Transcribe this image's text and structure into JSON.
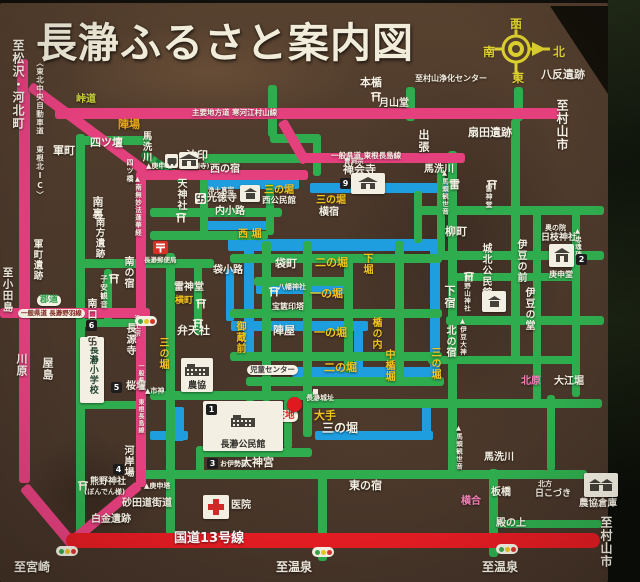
{
  "title": "長瀞ふるさと案内図",
  "compass": {
    "west": "西",
    "south": "南",
    "north": "北",
    "east": "東"
  },
  "colors": {
    "board_brown": "#4b382b",
    "road_pink": "#e5407e",
    "road_green": "#2fac4e",
    "road_red": "#e31c23",
    "moat_blue": "#1e9ede",
    "text_white": "#f4efe2",
    "text_yellow": "#f3c41d",
    "text_pink": "#f57fb8",
    "text_olive": "#c8d23e",
    "text_orange": "#e8a81c",
    "compass_yellow": "#ddd12f"
  },
  "labels": [
    {
      "t": "至松沢・河北町",
      "x": 12,
      "y": 36,
      "v": 1,
      "c": "w",
      "s": 12
    },
    {
      "t": "〈東北中央自動車道 東根北IC〉",
      "x": 36,
      "y": 56,
      "v": 1,
      "c": "w",
      "s": 7.5
    },
    {
      "t": "八反遺跡",
      "x": 541,
      "y": 66,
      "c": "w",
      "s": 11
    },
    {
      "t": "至村山浄化センター",
      "x": 415,
      "y": 72,
      "c": "w",
      "s": 8
    },
    {
      "t": "本楯",
      "x": 360,
      "y": 74,
      "c": "w",
      "s": 11
    },
    {
      "t": "月山堂",
      "x": 379,
      "y": 96,
      "c": "w",
      "s": 10
    },
    {
      "t": "至村山市",
      "x": 556,
      "y": 96,
      "v": 1,
      "c": "w",
      "s": 12
    },
    {
      "t": "扇田遺跡",
      "x": 468,
      "y": 124,
      "c": "w",
      "s": 11
    },
    {
      "t": "主要地方道 寒河江村山線",
      "x": 192,
      "y": 106,
      "c": "w",
      "s": 7.5
    },
    {
      "t": "一般県道 東根長島線",
      "x": 331,
      "y": 149,
      "c": "w",
      "s": 7.5
    },
    {
      "t": "峠道",
      "x": 76,
      "y": 92,
      "c": "yg",
      "s": 10
    },
    {
      "t": "陣場",
      "x": 118,
      "y": 116,
      "c": "o",
      "s": 11
    },
    {
      "t": "軍町",
      "x": 53,
      "y": 142,
      "c": "w",
      "s": 11
    },
    {
      "t": "四ツ壇",
      "x": 90,
      "y": 134,
      "c": "w",
      "s": 11
    },
    {
      "t": "馬洗川",
      "x": 141,
      "y": 128,
      "v": 1,
      "c": "w",
      "s": 9.5
    },
    {
      "t": "四ツ橋",
      "x": 126,
      "y": 156,
      "v": 1,
      "c": "w",
      "s": 7
    },
    {
      "t": "▲南無妙法蓮華経",
      "x": 134,
      "y": 172,
      "v": 1,
      "c": "w",
      "s": 6.5
    },
    {
      "t": "▲庚申塔",
      "x": 146,
      "y": 160,
      "c": "w",
      "s": 7
    },
    {
      "t": "法印",
      "x": 186,
      "y": 147,
      "c": "w",
      "s": 11
    },
    {
      "t": "(長源寺)",
      "x": 184,
      "y": 160,
      "c": "w",
      "s": 6.5
    },
    {
      "t": "西の宿",
      "x": 210,
      "y": 162,
      "c": "w",
      "s": 10
    },
    {
      "t": "天神社",
      "x": 175,
      "y": 175,
      "v": 1,
      "c": "w",
      "s": 10
    },
    {
      "t": "浄土真宗",
      "x": 208,
      "y": 184,
      "c": "w",
      "s": 6.5
    },
    {
      "t": "光徳寺",
      "x": 207,
      "y": 191,
      "c": "w",
      "s": 10
    },
    {
      "t": "三の堀",
      "x": 264,
      "y": 183,
      "c": "y",
      "s": 10
    },
    {
      "t": "西公民館",
      "x": 262,
      "y": 194,
      "c": "w",
      "s": 8.5
    },
    {
      "t": "内小路",
      "x": 215,
      "y": 204,
      "c": "w",
      "s": 10
    },
    {
      "t": "曹洞宗",
      "x": 344,
      "y": 155,
      "c": "w",
      "s": 6.5
    },
    {
      "t": "禅会寺",
      "x": 343,
      "y": 161,
      "c": "w",
      "s": 11
    },
    {
      "t": "馬洗川",
      "x": 424,
      "y": 162,
      "c": "w",
      "s": 10
    },
    {
      "t": "出張",
      "x": 418,
      "y": 126,
      "v": 1,
      "c": "w",
      "s": 11
    },
    {
      "t": "▲馬頭観世音",
      "x": 441,
      "y": 166,
      "v": 1,
      "c": "w",
      "s": 6.5
    },
    {
      "t": "西 堀",
      "x": 238,
      "y": 227,
      "c": "y",
      "s": 10
    },
    {
      "t": "袋小路",
      "x": 213,
      "y": 263,
      "c": "w",
      "s": 10
    },
    {
      "t": "袋町",
      "x": 275,
      "y": 255,
      "c": "w",
      "s": 11
    },
    {
      "t": "二の堀",
      "x": 315,
      "y": 254,
      "c": "y",
      "s": 11
    },
    {
      "t": "下堀",
      "x": 361,
      "y": 250,
      "v": 1,
      "c": "y",
      "s": 10
    },
    {
      "t": "八幡神社",
      "x": 278,
      "y": 281,
      "c": "w",
      "s": 7
    },
    {
      "t": "一の堀",
      "x": 310,
      "y": 285,
      "c": "y",
      "s": 11
    },
    {
      "t": "宝篋印塔",
      "x": 272,
      "y": 300,
      "c": "w",
      "s": 8
    },
    {
      "t": "陣屋",
      "x": 273,
      "y": 322,
      "c": "w",
      "s": 11
    },
    {
      "t": "一の堀",
      "x": 314,
      "y": 324,
      "c": "y",
      "s": 11
    },
    {
      "t": "楯の内",
      "x": 370,
      "y": 314,
      "v": 1,
      "c": "y",
      "s": 10
    },
    {
      "t": "中楯堀",
      "x": 383,
      "y": 346,
      "v": 1,
      "c": "y",
      "s": 10
    },
    {
      "t": "二の堀",
      "x": 324,
      "y": 359,
      "c": "y",
      "s": 11
    },
    {
      "t": "御蔵前",
      "x": 234,
      "y": 318,
      "v": 1,
      "c": "y",
      "s": 10
    },
    {
      "t": "雷神堂",
      "x": 174,
      "y": 280,
      "c": "w",
      "s": 10
    },
    {
      "t": "横町",
      "x": 175,
      "y": 294,
      "c": "y",
      "s": 9
    },
    {
      "t": "弁天社",
      "x": 177,
      "y": 322,
      "c": "w",
      "s": 11
    },
    {
      "t": "三の堀",
      "x": 157,
      "y": 334,
      "v": 1,
      "c": "y",
      "s": 10
    },
    {
      "t": "南の宿",
      "x": 122,
      "y": 253,
      "v": 1,
      "c": "w",
      "s": 10
    },
    {
      "t": "子安観音",
      "x": 100,
      "y": 272,
      "v": 1,
      "c": "w",
      "s": 7.5
    },
    {
      "t": "南口",
      "x": 85,
      "y": 295,
      "v": 1,
      "c": "w",
      "s": 10
    },
    {
      "t": "浄土宗",
      "x": 133,
      "y": 312,
      "v": 1,
      "c": "w",
      "s": 6.5
    },
    {
      "t": "長源寺",
      "x": 124,
      "y": 320,
      "v": 1,
      "c": "w",
      "s": 10
    },
    {
      "t": "桜壇",
      "x": 126,
      "y": 379,
      "c": "w",
      "s": 10
    },
    {
      "t": "▲市神",
      "x": 145,
      "y": 385,
      "c": "w",
      "s": 7
    },
    {
      "t": "雷",
      "x": 449,
      "y": 176,
      "c": "w",
      "s": 11
    },
    {
      "t": "雷神堂",
      "x": 485,
      "y": 182,
      "v": 1,
      "c": "w",
      "s": 7
    },
    {
      "t": "柳町",
      "x": 445,
      "y": 223,
      "c": "w",
      "s": 11
    },
    {
      "t": "城北公民館",
      "x": 480,
      "y": 240,
      "v": 1,
      "c": "w",
      "s": 10
    },
    {
      "t": "熊野山神社",
      "x": 463,
      "y": 272,
      "v": 1,
      "c": "w",
      "s": 6.5
    },
    {
      "t": "下宿",
      "x": 444,
      "y": 282,
      "v": 1,
      "c": "w",
      "s": 11
    },
    {
      "t": "伊豆の前",
      "x": 515,
      "y": 236,
      "v": 1,
      "c": "w",
      "s": 10
    },
    {
      "t": "奥の院",
      "x": 545,
      "y": 222,
      "c": "w",
      "s": 7
    },
    {
      "t": "日枝神社",
      "x": 541,
      "y": 231,
      "c": "w",
      "s": 9
    },
    {
      "t": "庚申堂",
      "x": 549,
      "y": 268,
      "c": "w",
      "s": 8
    },
    {
      "t": "▲忠魂碑",
      "x": 574,
      "y": 224,
      "v": 1,
      "c": "w",
      "s": 6.5
    },
    {
      "t": "伊豆の堂",
      "x": 523,
      "y": 284,
      "v": 1,
      "c": "w",
      "s": 10
    },
    {
      "t": "▲伊豆大神",
      "x": 459,
      "y": 314,
      "v": 1,
      "c": "w",
      "s": 6.5
    },
    {
      "t": "北の宿",
      "x": 444,
      "y": 322,
      "v": 1,
      "c": "w",
      "s": 10
    },
    {
      "t": "三の堀",
      "x": 429,
      "y": 344,
      "v": 1,
      "c": "y",
      "s": 10
    },
    {
      "t": "北原",
      "x": 521,
      "y": 374,
      "c": "p",
      "s": 10
    },
    {
      "t": "大江堀",
      "x": 554,
      "y": 374,
      "c": "w",
      "s": 10
    },
    {
      "t": "馬洗川",
      "x": 484,
      "y": 450,
      "c": "w",
      "s": 10
    },
    {
      "t": "板橋",
      "x": 491,
      "y": 485,
      "c": "w",
      "s": 10
    },
    {
      "t": "横合",
      "x": 461,
      "y": 494,
      "c": "p",
      "s": 10
    },
    {
      "t": "北方",
      "x": 538,
      "y": 478,
      "c": "w",
      "s": 7
    },
    {
      "t": "日こづき",
      "x": 535,
      "y": 487,
      "c": "w",
      "s": 9
    },
    {
      "t": "農協倉庫",
      "x": 579,
      "y": 496,
      "c": "w",
      "s": 9.5
    },
    {
      "t": "殿の上",
      "x": 496,
      "y": 516,
      "c": "w",
      "s": 10
    },
    {
      "t": "東の宿",
      "x": 349,
      "y": 477,
      "c": "w",
      "s": 11
    },
    {
      "t": "▲馬頭観世音",
      "x": 455,
      "y": 421,
      "v": 1,
      "c": "w",
      "s": 6.5
    },
    {
      "t": "白金遺跡",
      "x": 91,
      "y": 512,
      "c": "w",
      "s": 10
    },
    {
      "t": "▲庚申塔",
      "x": 144,
      "y": 480,
      "c": "w",
      "s": 7
    },
    {
      "t": "熊野神社",
      "x": 90,
      "y": 475,
      "c": "w",
      "s": 9
    },
    {
      "t": "(ぼんでん様)",
      "x": 84,
      "y": 486,
      "c": "w",
      "s": 7
    },
    {
      "t": "河岸場",
      "x": 122,
      "y": 442,
      "v": 1,
      "c": "w",
      "s": 10
    },
    {
      "t": "お伊勢様",
      "x": 220,
      "y": 458,
      "c": "w",
      "s": 7
    },
    {
      "t": "大神宮",
      "x": 241,
      "y": 454,
      "c": "w",
      "s": 11
    },
    {
      "t": "医院",
      "x": 231,
      "y": 498,
      "c": "w",
      "s": 10
    },
    {
      "t": "長瀞城址",
      "x": 306,
      "y": 392,
      "c": "w",
      "s": 7
    },
    {
      "t": "大手",
      "x": 314,
      "y": 407,
      "c": "y",
      "s": 11
    },
    {
      "t": "三の堀",
      "x": 322,
      "y": 419,
      "c": "w",
      "s": 12
    },
    {
      "t": "長瀞郵便局",
      "x": 144,
      "y": 254,
      "c": "w",
      "s": 6.5
    },
    {
      "t": "横宿",
      "x": 319,
      "y": 205,
      "c": "w",
      "s": 10
    },
    {
      "t": "三の堀",
      "x": 316,
      "y": 193,
      "c": "y",
      "s": 10
    },
    {
      "t": "南裏",
      "x": 92,
      "y": 193,
      "v": 1,
      "c": "w",
      "s": 11
    },
    {
      "t": "南方遺跡",
      "x": 94,
      "y": 214,
      "v": 1,
      "c": "w",
      "s": 9.5
    },
    {
      "t": "軍町遺跡",
      "x": 32,
      "y": 236,
      "v": 1,
      "c": "w",
      "s": 9.5
    },
    {
      "t": "至小田島",
      "x": 2,
      "y": 264,
      "v": 1,
      "c": "w",
      "s": 10.5
    },
    {
      "t": "川原",
      "x": 16,
      "y": 350,
      "v": 1,
      "c": "w",
      "s": 11
    },
    {
      "t": "屋島",
      "x": 42,
      "y": 354,
      "v": 1,
      "c": "w",
      "s": 11
    },
    {
      "t": "砂田道街道",
      "x": 122,
      "y": 496,
      "c": "w",
      "s": 10
    },
    {
      "t": "国道13号線",
      "x": 174,
      "y": 529,
      "c": "wb",
      "s": 13
    },
    {
      "t": "至宮崎",
      "x": 14,
      "y": 558,
      "c": "w",
      "s": 12
    },
    {
      "t": "至温泉",
      "x": 276,
      "y": 558,
      "c": "w",
      "s": 12
    },
    {
      "t": "至温泉",
      "x": 482,
      "y": 558,
      "c": "w",
      "s": 12
    },
    {
      "t": "至村山市",
      "x": 600,
      "y": 513,
      "v": 1,
      "c": "w",
      "s": 12
    },
    {
      "t": "一般県道 東根長島線",
      "x": 137,
      "y": 360,
      "v": 1,
      "c": "w",
      "s": 6
    }
  ],
  "pills": [
    {
      "t": "児童センター",
      "x": 247,
      "y": 362,
      "fg": "#3a3a3a",
      "s": 7.5
    },
    {
      "t": "現在地",
      "x": 263,
      "y": 407,
      "fg": "#d42828",
      "s": 9.5
    },
    {
      "t": "郡道",
      "x": 37,
      "y": 292,
      "fg": "#2d9e4a",
      "s": 9
    },
    {
      "t": "一般県道 長瀞野羽線",
      "x": 18,
      "y": 306,
      "fg": "#7c241c",
      "s": 6.5
    }
  ],
  "boxes": [
    {
      "x": 203,
      "y": 398,
      "w": 80,
      "h": 50,
      "glyph": "hall",
      "cap": "長瀞公民館",
      "cs": 9
    },
    {
      "x": 181,
      "y": 355,
      "w": 32,
      "h": 34,
      "glyph": "hall",
      "cap": "農協",
      "cs": 9
    },
    {
      "x": 584,
      "y": 470,
      "w": 34,
      "h": 24,
      "glyph": "barn"
    },
    {
      "x": 482,
      "y": 288,
      "w": 24,
      "h": 21,
      "glyph": "house"
    },
    {
      "x": 351,
      "y": 170,
      "w": 34,
      "h": 21,
      "glyph": "temple"
    },
    {
      "x": 179,
      "y": 149,
      "w": 19,
      "h": 17,
      "glyph": "temple"
    },
    {
      "x": 165,
      "y": 151,
      "w": 13,
      "h": 14,
      "glyph": "bus"
    },
    {
      "x": 549,
      "y": 241,
      "w": 25,
      "h": 23,
      "glyph": "shrine"
    },
    {
      "x": 240,
      "y": 182,
      "w": 20,
      "h": 17,
      "glyph": "house"
    },
    {
      "x": 203,
      "y": 492,
      "w": 26,
      "h": 24,
      "glyph": "cross"
    },
    {
      "x": 80,
      "y": 334,
      "w": 24,
      "h": 66,
      "glyph": "school",
      "cap": "長瀞小学校",
      "cs": 9,
      "capv": 1
    },
    {
      "x": 151,
      "y": 236,
      "w": 19,
      "h": 17,
      "glyph": "post"
    }
  ],
  "badges": [
    {
      "n": "1",
      "x": 206,
      "y": 401
    },
    {
      "n": "2",
      "x": 576,
      "y": 251
    },
    {
      "n": "3",
      "x": 207,
      "y": 455
    },
    {
      "n": "4",
      "x": 113,
      "y": 461
    },
    {
      "n": "5",
      "x": 111,
      "y": 379
    },
    {
      "n": "6",
      "x": 86,
      "y": 317
    },
    {
      "n": "9",
      "x": 340,
      "y": 175
    }
  ],
  "icons": [
    {
      "k": "torii",
      "x": 370,
      "y": 84
    },
    {
      "k": "torii",
      "x": 175,
      "y": 205
    },
    {
      "k": "torii",
      "x": 195,
      "y": 291
    },
    {
      "k": "torii",
      "x": 192,
      "y": 311
    },
    {
      "k": "torii",
      "x": 108,
      "y": 266
    },
    {
      "k": "torii",
      "x": 486,
      "y": 172
    },
    {
      "k": "torii",
      "x": 463,
      "y": 264
    },
    {
      "k": "torii",
      "x": 268,
      "y": 279
    },
    {
      "k": "torii",
      "x": 77,
      "y": 473
    },
    {
      "k": "manji",
      "x": 195,
      "y": 186
    },
    {
      "k": "manji",
      "x": 87,
      "y": 329
    },
    {
      "k": "traffic-light",
      "x": 135,
      "y": 313
    },
    {
      "k": "traffic-light",
      "x": 56,
      "y": 543
    },
    {
      "k": "traffic-light",
      "x": 312,
      "y": 544
    },
    {
      "k": "traffic-light",
      "x": 496,
      "y": 541
    },
    {
      "k": "current-location-dot",
      "x": 287,
      "y": 394
    },
    {
      "k": "castle-site-marker",
      "x": 313,
      "y": 386
    }
  ]
}
